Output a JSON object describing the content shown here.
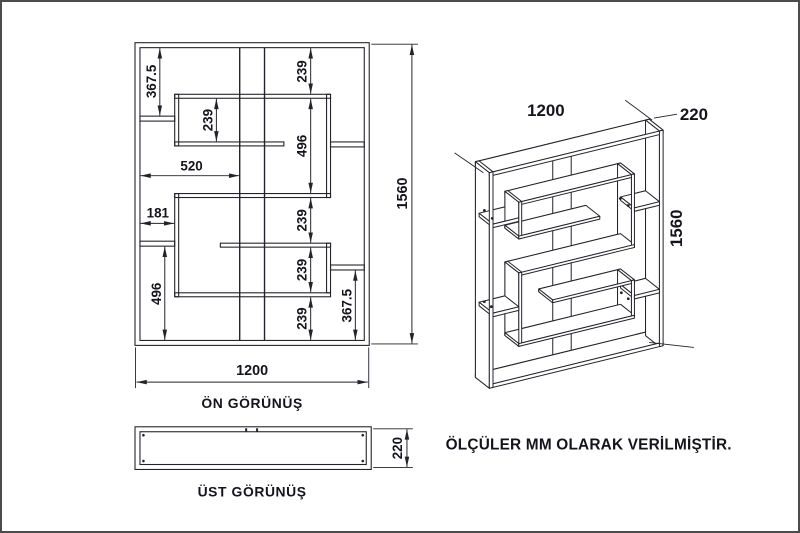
{
  "colors": {
    "line": "#23232b",
    "text": "#14141c",
    "border": "#4b4b4b",
    "background": "#ffffff"
  },
  "front_view": {
    "caption": "ÖN GÖRÜNÜŞ",
    "dims": {
      "left_top": "367.5",
      "upper_box": "239",
      "right_top": "239",
      "right_mid": "496",
      "right_low1": "239",
      "right_low2": "239",
      "right_low3": "239",
      "right_bottom": "367.5",
      "left_bottom": "496",
      "height": "1560",
      "shelf_offset": "520",
      "niche_width": "181",
      "width": "1200"
    }
  },
  "top_view": {
    "caption": "ÜST GÖRÜNÜŞ",
    "dims": {
      "depth": "220"
    }
  },
  "iso_view": {
    "dims": {
      "width": "1200",
      "depth": "220",
      "height": "1560"
    }
  },
  "note": "ÖLÇÜLER MM OLARAK VERİLMİŞTİR."
}
